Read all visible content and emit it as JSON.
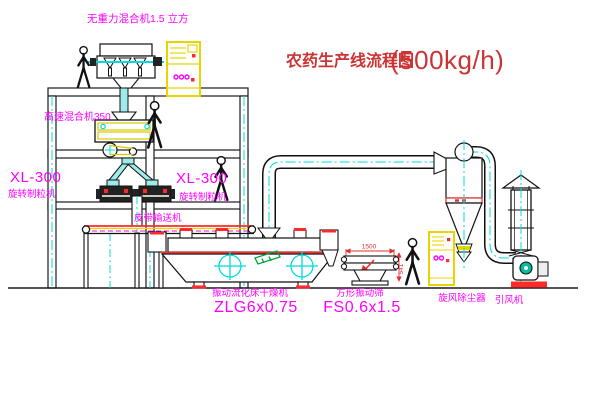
{
  "title": {
    "main": "农药生产线流程图",
    "capacity": "(500kg/h)"
  },
  "labels": {
    "top_mixer": "无重力混合机1.5 立方",
    "high_speed_mixer": "高速混合机350",
    "xl300_left": "XL-300",
    "granulator_left": "旋转制粒机",
    "xl300_right": "XL-300",
    "granulator_right": "旋转制粒机",
    "belt_conveyor": "皮带输送机",
    "dryer_name": "振动流化床干燥机",
    "dryer_model": "ZLG6x0.75",
    "sieve_name": "方形振动筛",
    "sieve_model": "FS0.6x1.5",
    "cyclone": "旋风除尘器",
    "fan": "引风机"
  },
  "dimensions": {
    "sieve_length": "1500",
    "sieve_height": "541"
  },
  "colors": {
    "label_magenta": "#ff00ff",
    "title_red": "#cc3333",
    "line_black": "#1a1a1a",
    "centerline_cyan": "#00dcdc",
    "cabinet_yellow": "#e8d500",
    "accent_red": "#ff2a2a",
    "tag_green": "#00a33c",
    "fan_teal": "#00bfa0"
  }
}
